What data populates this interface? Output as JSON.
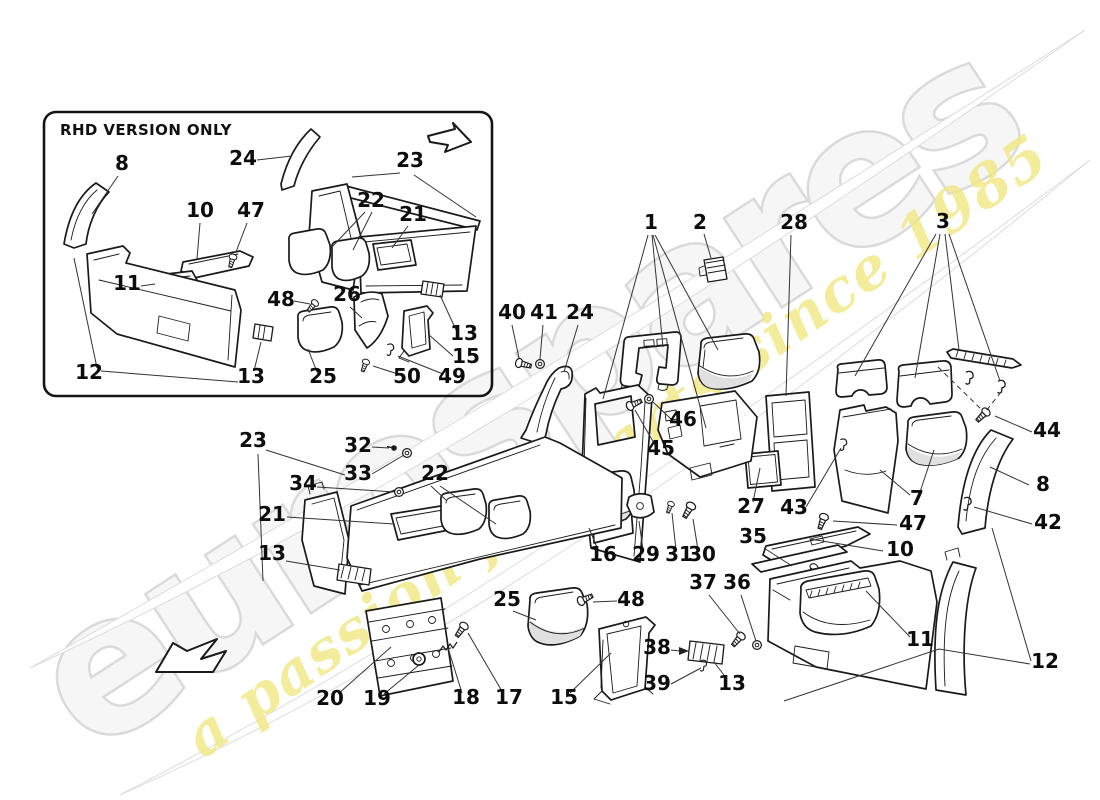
{
  "watermark": {
    "brand": "eurospares",
    "tagline": "a passion for parts since 1985",
    "brand_color": "#ebebeb",
    "tagline_color": "#f1e883"
  },
  "inset": {
    "title": "RHD VERSION ONLY",
    "callouts": [
      {
        "text": "8",
        "x": 122,
        "y": 170,
        "leaders": [
          [
            [
              118,
              176
            ],
            [
              92,
              214
            ]
          ]
        ]
      },
      {
        "text": "24",
        "x": 243,
        "y": 165,
        "leaders": [
          [
            [
              257,
              160
            ],
            [
              292,
              156
            ]
          ]
        ]
      },
      {
        "text": "23",
        "x": 410,
        "y": 167,
        "leaders": [
          [
            [
              400,
              173
            ],
            [
              352,
              177
            ]
          ],
          [
            [
              414,
              175
            ],
            [
              476,
              217
            ]
          ]
        ]
      },
      {
        "text": "10",
        "x": 200,
        "y": 217,
        "leaders": [
          [
            [
              200,
              223
            ],
            [
              197,
              259
            ]
          ]
        ]
      },
      {
        "text": "47",
        "x": 251,
        "y": 217,
        "leaders": [
          [
            [
              247,
              223
            ],
            [
              236,
              252
            ]
          ]
        ]
      },
      {
        "text": "22",
        "x": 371,
        "y": 207,
        "leaders": [
          [
            [
              365,
              212
            ],
            [
              331,
              248
            ]
          ],
          [
            [
              372,
              212
            ],
            [
              353,
              250
            ]
          ]
        ]
      },
      {
        "text": "21",
        "x": 413,
        "y": 221,
        "leaders": [
          [
            [
              408,
              226
            ],
            [
              392,
              248
            ]
          ]
        ]
      },
      {
        "text": "11",
        "x": 127,
        "y": 290,
        "leaders": [
          [
            [
              141,
              286
            ],
            [
              155,
              284
            ]
          ]
        ]
      },
      {
        "text": "48",
        "x": 281,
        "y": 306,
        "leaders": [
          [
            [
              294,
              301
            ],
            [
              310,
              304
            ]
          ]
        ]
      },
      {
        "text": "26",
        "x": 347,
        "y": 301,
        "leaders": [
          [
            [
              350,
              307
            ],
            [
              362,
              318
            ]
          ]
        ]
      },
      {
        "text": "12",
        "x": 89,
        "y": 379,
        "leaders": [
          [
            [
              97,
              368
            ],
            [
              74,
              258
            ]
          ],
          [
            [
              101,
              371
            ],
            [
              238,
              382
            ]
          ]
        ]
      },
      {
        "text": "13",
        "x": 251,
        "y": 383,
        "leaders": [
          [
            [
              254,
              371
            ],
            [
              261,
              342
            ]
          ]
        ]
      },
      {
        "text": "25",
        "x": 323,
        "y": 383,
        "leaders": [
          [
            [
              317,
              372
            ],
            [
              308,
              349
            ]
          ]
        ]
      },
      {
        "text": "50",
        "x": 407,
        "y": 383,
        "leaders": [
          [
            [
              398,
              374
            ],
            [
              373,
              366
            ]
          ]
        ]
      },
      {
        "text": "49",
        "x": 452,
        "y": 383,
        "leaders": [
          [
            [
              443,
              374
            ],
            [
              398,
              356
            ]
          ]
        ]
      },
      {
        "text": "13",
        "x": 464,
        "y": 340,
        "leaders": [
          [
            [
              456,
              330
            ],
            [
              440,
              295
            ]
          ]
        ]
      },
      {
        "text": "15",
        "x": 466,
        "y": 363,
        "leaders": [
          [
            [
              453,
              356
            ],
            [
              428,
              334
            ]
          ]
        ]
      }
    ]
  },
  "main": {
    "callouts": [
      {
        "text": "1",
        "x": 651,
        "y": 229,
        "leaders": [
          [
            [
              648,
              235
            ],
            [
              603,
              399
            ]
          ],
          [
            [
              652,
              235
            ],
            [
              663,
              347
            ]
          ],
          [
            [
              655,
              235
            ],
            [
              718,
              350
            ]
          ],
          [
            [
              653,
              235
            ],
            [
              706,
              428
            ]
          ]
        ]
      },
      {
        "text": "2",
        "x": 700,
        "y": 229,
        "leaders": [
          [
            [
              704,
              234
            ],
            [
              711,
              258
            ]
          ]
        ]
      },
      {
        "text": "28",
        "x": 794,
        "y": 229,
        "leaders": [
          [
            [
              791,
              235
            ],
            [
              786,
              396
            ]
          ]
        ]
      },
      {
        "text": "3",
        "x": 943,
        "y": 228,
        "leaders": [
          [
            [
              936,
              234
            ],
            [
              855,
              376
            ]
          ],
          [
            [
              940,
              234
            ],
            [
              915,
              378
            ]
          ],
          [
            [
              945,
              234
            ],
            [
              959,
              350
            ]
          ],
          [
            [
              949,
              234
            ],
            [
              1000,
              381
            ]
          ]
        ]
      },
      {
        "text": "44",
        "x": 1047,
        "y": 437,
        "leaders": [
          [
            [
              1032,
              432
            ],
            [
              995,
              416
            ]
          ]
        ]
      },
      {
        "text": "40",
        "x": 512,
        "y": 319,
        "leaders": [
          [
            [
              512,
              325
            ],
            [
              519,
              358
            ]
          ]
        ]
      },
      {
        "text": "41",
        "x": 544,
        "y": 319,
        "leaders": [
          [
            [
              543,
              325
            ],
            [
              540,
              359
            ]
          ]
        ]
      },
      {
        "text": "24",
        "x": 580,
        "y": 319,
        "leaders": [
          [
            [
              578,
              325
            ],
            [
              564,
              372
            ]
          ]
        ]
      },
      {
        "text": "46",
        "x": 683,
        "y": 426,
        "leaders": [
          [
            [
              671,
              419
            ],
            [
              653,
              402
            ]
          ]
        ]
      },
      {
        "text": "45",
        "x": 661,
        "y": 455,
        "leaders": [
          [
            [
              655,
              445
            ],
            [
              635,
              410
            ]
          ]
        ]
      },
      {
        "text": "27",
        "x": 751,
        "y": 513,
        "leaders": [
          [
            [
              753,
              502
            ],
            [
              760,
              468
            ]
          ]
        ]
      },
      {
        "text": "43",
        "x": 794,
        "y": 514,
        "leaders": [
          [
            [
              806,
              507
            ],
            [
              841,
              448
            ]
          ]
        ]
      },
      {
        "text": "7",
        "x": 917,
        "y": 505,
        "leaders": [
          [
            [
              910,
              495
            ],
            [
              880,
              470
            ]
          ],
          [
            [
              919,
              495
            ],
            [
              934,
              450
            ]
          ]
        ]
      },
      {
        "text": "8",
        "x": 1043,
        "y": 491,
        "leaders": [
          [
            [
              1029,
              485
            ],
            [
              990,
              467
            ]
          ]
        ]
      },
      {
        "text": "42",
        "x": 1048,
        "y": 529,
        "leaders": [
          [
            [
              1032,
              524
            ],
            [
              974,
              507
            ]
          ]
        ]
      },
      {
        "text": "47",
        "x": 913,
        "y": 530,
        "leaders": [
          [
            [
              897,
              525
            ],
            [
              833,
              521
            ]
          ]
        ]
      },
      {
        "text": "10",
        "x": 900,
        "y": 556,
        "leaders": [
          [
            [
              883,
              551
            ],
            [
              810,
              539
            ]
          ]
        ]
      },
      {
        "text": "35",
        "x": 753,
        "y": 543,
        "leaders": [
          [
            [
              764,
              548
            ],
            [
              792,
              566
            ]
          ]
        ]
      },
      {
        "text": "37",
        "x": 703,
        "y": 589,
        "leaders": [
          [
            [
              709,
              595
            ],
            [
              740,
              634
            ]
          ]
        ]
      },
      {
        "text": "36",
        "x": 737,
        "y": 589,
        "leaders": [
          [
            [
              741,
              595
            ],
            [
              756,
              641
            ]
          ]
        ]
      },
      {
        "text": "38",
        "x": 657,
        "y": 654,
        "leaders": [
          [
            [
              671,
              650
            ],
            [
              680,
              651
            ]
          ]
        ],
        "arrow": [
          [
            689,
            651
          ],
          [
            679,
            647
          ],
          [
            679,
            655
          ]
        ]
      },
      {
        "text": "39",
        "x": 657,
        "y": 690,
        "leaders": [
          [
            [
              671,
              684
            ],
            [
              701,
              668
            ]
          ]
        ]
      },
      {
        "text": "13",
        "x": 732,
        "y": 690,
        "leaders": [
          [
            [
              727,
              679
            ],
            [
              714,
              662
            ]
          ]
        ]
      },
      {
        "text": "15",
        "x": 564,
        "y": 704,
        "leaders": [
          [
            [
              570,
              693
            ],
            [
              611,
              653
            ]
          ]
        ]
      },
      {
        "text": "25",
        "x": 507,
        "y": 606,
        "leaders": [
          [
            [
              513,
              611
            ],
            [
              536,
              620
            ]
          ]
        ]
      },
      {
        "text": "48",
        "x": 631,
        "y": 606,
        "leaders": [
          [
            [
              617,
              601
            ],
            [
              593,
              602
            ]
          ]
        ]
      },
      {
        "text": "20",
        "x": 330,
        "y": 705,
        "leaders": [
          [
            [
              338,
              694
            ],
            [
              391,
              647
            ]
          ]
        ]
      },
      {
        "text": "19",
        "x": 377,
        "y": 705,
        "leaders": [
          [
            [
              384,
              694
            ],
            [
              419,
              665
            ]
          ]
        ]
      },
      {
        "text": "18",
        "x": 466,
        "y": 704,
        "leaders": [
          [
            [
              462,
              693
            ],
            [
              448,
              648
            ]
          ]
        ]
      },
      {
        "text": "17",
        "x": 509,
        "y": 704,
        "leaders": [
          [
            [
              503,
              693
            ],
            [
              468,
              633
            ]
          ]
        ]
      },
      {
        "text": "16",
        "x": 603,
        "y": 561,
        "leaders": [
          [
            [
              598,
              550
            ],
            [
              589,
              528
            ]
          ]
        ]
      },
      {
        "text": "29",
        "x": 646,
        "y": 561,
        "leaders": [
          [
            [
              643,
              550
            ],
            [
              639,
              521
            ]
          ]
        ]
      },
      {
        "text": "31",
        "x": 679,
        "y": 561,
        "leaders": [
          [
            [
              676,
              550
            ],
            [
              672,
              513
            ]
          ]
        ]
      },
      {
        "text": "30",
        "x": 702,
        "y": 561,
        "leaders": [
          [
            [
              698,
              550
            ],
            [
              693,
              519
            ]
          ]
        ]
      },
      {
        "text": "32",
        "x": 358,
        "y": 452,
        "leaders": [
          [
            [
              372,
              447
            ],
            [
              389,
              448
            ]
          ]
        ]
      },
      {
        "text": "33",
        "x": 358,
        "y": 480,
        "leaders": [
          [
            [
              372,
              474
            ],
            [
              404,
              455
            ]
          ]
        ]
      },
      {
        "text": "34",
        "x": 303,
        "y": 490,
        "leaders": [
          [
            [
              317,
              487
            ],
            [
              395,
              492
            ]
          ]
        ]
      },
      {
        "text": "23",
        "x": 253,
        "y": 447,
        "leaders": [
          [
            [
              266,
              450
            ],
            [
              345,
              475
            ]
          ],
          [
            [
              258,
              454
            ],
            [
              263,
              581
            ]
          ]
        ]
      },
      {
        "text": "21",
        "x": 272,
        "y": 521,
        "leaders": [
          [
            [
              287,
              517
            ],
            [
              394,
              524
            ]
          ]
        ]
      },
      {
        "text": "13",
        "x": 272,
        "y": 560,
        "leaders": [
          [
            [
              286,
              561
            ],
            [
              340,
              570
            ]
          ]
        ]
      },
      {
        "text": "22",
        "x": 435,
        "y": 480,
        "leaders": [
          [
            [
              431,
              486
            ],
            [
              446,
              500
            ]
          ],
          [
            [
              440,
              486
            ],
            [
              496,
              524
            ]
          ]
        ]
      },
      {
        "text": "11",
        "x": 920,
        "y": 646,
        "leaders": [
          [
            [
              910,
              637
            ],
            [
              866,
              591
            ]
          ]
        ]
      },
      {
        "text": "12",
        "x": 1045,
        "y": 668,
        "leaders": [
          [
            [
              1031,
              661
            ],
            [
              992,
              528
            ]
          ],
          [
            [
              1030,
              664
            ],
            [
              939,
              649
            ],
            [
              784,
              701
            ]
          ]
        ]
      }
    ],
    "dashed_leaders": [
      [
        [
          938,
          367
        ],
        [
          983,
          411
        ]
      ],
      [
        [
          1001,
          392
        ],
        [
          986,
          411
        ]
      ]
    ]
  }
}
